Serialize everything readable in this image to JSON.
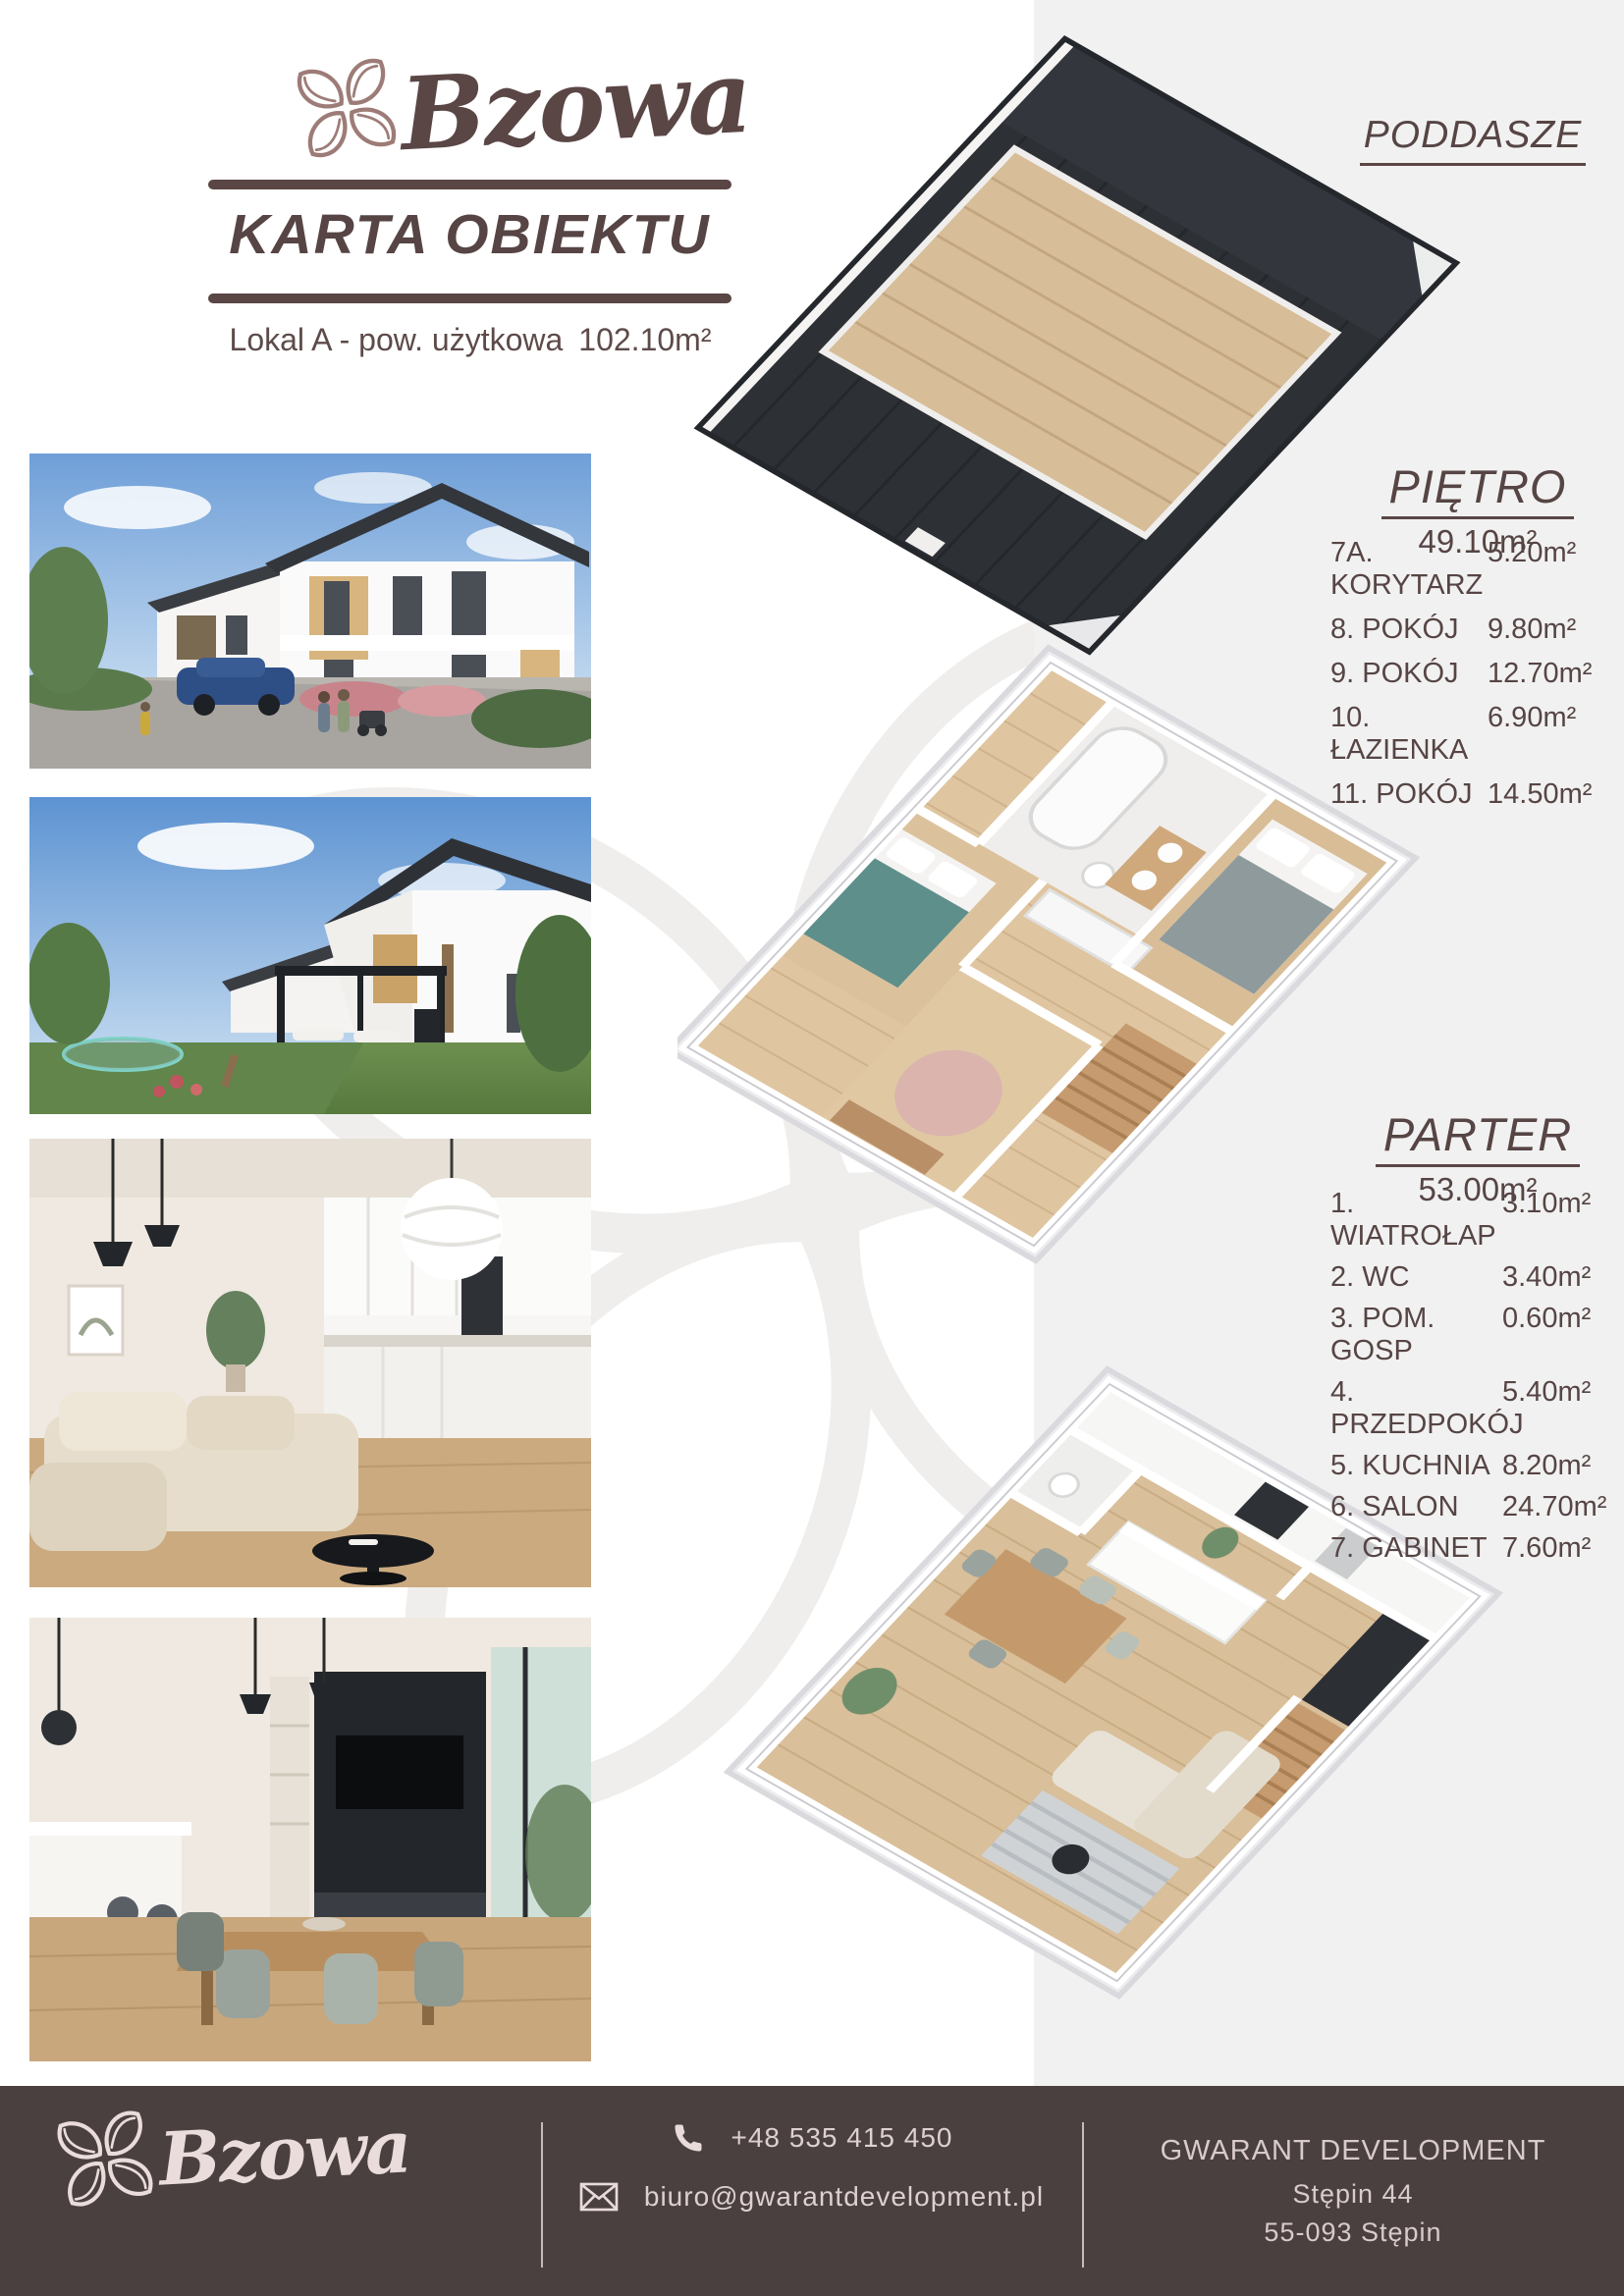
{
  "brand": {
    "name": "Bzowa",
    "card_title": "KARTA OBIEKTU",
    "unit_label": "Lokal A - pow. użytkowa",
    "unit_area": "102.10m²"
  },
  "colors": {
    "brand_brown": "#5a4645",
    "logo_mauve": "#9d7c78",
    "panel_gray": "#f1f1f1",
    "footer_bg": "#4a4040",
    "footer_text": "#ddd0cf"
  },
  "icons": {
    "logo": "flower-icon",
    "phone": "phone-handset-icon",
    "email": "envelope-icon"
  },
  "photos": [
    {
      "name": "exterior-front-street-view"
    },
    {
      "name": "exterior-garden-pergola-view"
    },
    {
      "name": "interior-living-room-kitchen"
    },
    {
      "name": "interior-dining-area"
    }
  ],
  "floors": [
    {
      "id": "poddasze",
      "label": "PODDASZE",
      "area": "",
      "rooms": []
    },
    {
      "id": "pietro",
      "label": "PIĘTRO",
      "area": "49.10m²",
      "rooms": [
        {
          "label": "7A. KORYTARZ",
          "area": "5.20m²"
        },
        {
          "label": "8. POKÓJ",
          "area": "9.80m²"
        },
        {
          "label": "9. POKÓJ",
          "area": "12.70m²"
        },
        {
          "label": "10. ŁAZIENKA",
          "area": "6.90m²"
        },
        {
          "label": "11. POKÓJ",
          "area": "14.50m²"
        }
      ]
    },
    {
      "id": "parter",
      "label": "PARTER",
      "area": "53.00m²",
      "rooms": [
        {
          "label": "1. WIATROŁAP",
          "area": "3.10m²"
        },
        {
          "label": "2. WC",
          "area": "3.40m²"
        },
        {
          "label": "3. POM. GOSP",
          "area": "0.60m²"
        },
        {
          "label": "4. PRZEDPOKÓJ",
          "area": "5.40m²"
        },
        {
          "label": "5. KUCHNIA",
          "area": "8.20m²"
        },
        {
          "label": "6. SALON",
          "area": "24.70m²"
        },
        {
          "label": "7. GABINET",
          "area": "7.60m²"
        }
      ]
    }
  ],
  "footer": {
    "phone": "+48 535 415 450",
    "email": "biuro@gwarantdevelopment.pl",
    "company": "GWARANT DEVELOPMENT",
    "address_line1": "Stępin 44",
    "address_line2": "55-093 Stępin"
  }
}
